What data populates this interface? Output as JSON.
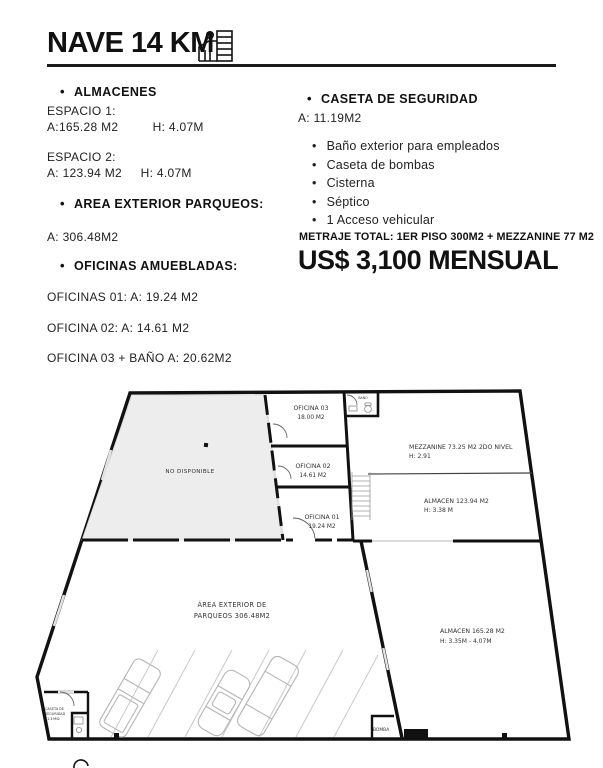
{
  "icons": {
    "bullet": "•",
    "building_icon": "building-icon"
  },
  "header": {
    "title": "NAVE 14 KM"
  },
  "left_column": {
    "almacenes": {
      "heading": "ALMACENES",
      "spaces": [
        {
          "label": "ESPACIO 1:",
          "area": "A:165.28 M2",
          "height": "H:  4.07M"
        },
        {
          "label": "ESPACIO 2:",
          "area": "A: 123.94 M2",
          "height": "H: 4.07M"
        }
      ]
    },
    "parqueos": {
      "heading": "AREA EXTERIOR PARQUEOS:",
      "area": "A:  306.48M2"
    },
    "oficinas": {
      "heading": "OFICINAS AMUEBLADAS:",
      "items": [
        "OFICINAS 01: A: 19.24 M2",
        "OFICINA 02: A: 14.61 M2",
        "OFICINA 03 + BAÑO A: 20.62M2"
      ]
    }
  },
  "right_column": {
    "caseta": {
      "heading": "CASETA DE SEGURIDAD",
      "area": "A: 11.19M2"
    },
    "features": [
      "Baño exterior para empleados",
      "Caseta de bombas",
      "Cisterna",
      "Séptico",
      "1 Acceso vehicular"
    ],
    "metraje": "METRAJE TOTAL: 1ER PISO 300M2 + MEZZANINE  77 M2",
    "price": "US$ 3,100 MENSUAL"
  },
  "plan": {
    "no_disponible": "NO DISPONIBLE",
    "bano": "BAÑO",
    "oficina03": {
      "line1": "OFICINA 03",
      "line2": "18.00 M2"
    },
    "oficina02": {
      "line1": "OFICINA 02",
      "line2": "14.61 M2"
    },
    "oficina01": {
      "line1": "OFICINA 01",
      "line2": "19.24 M2"
    },
    "mezzanine": {
      "line1": "MEZZANINE 73.25 M2 2DO NIVEL",
      "line2": "H: 2.91"
    },
    "almacen_123": {
      "line1": "ALMACEN 123.94 M2",
      "line2": "H: 3.38 M"
    },
    "almacen_165": {
      "line1": "ALMACEN 165.28 M2",
      "line2": "H:  3.35M - 4.07M"
    },
    "parqueos": {
      "line1": "ÁREA EXTERIOR DE",
      "line2": "PARQUEOS 306.48M2"
    },
    "caseta": {
      "line1": "CASETA DE",
      "line2": "SEGURIDAD",
      "line3": "11.19M2"
    },
    "bomba": "BOMBA"
  },
  "colors": {
    "wall": "#111111",
    "grey_area": "#ededed",
    "light_line": "#c9c9c9"
  }
}
